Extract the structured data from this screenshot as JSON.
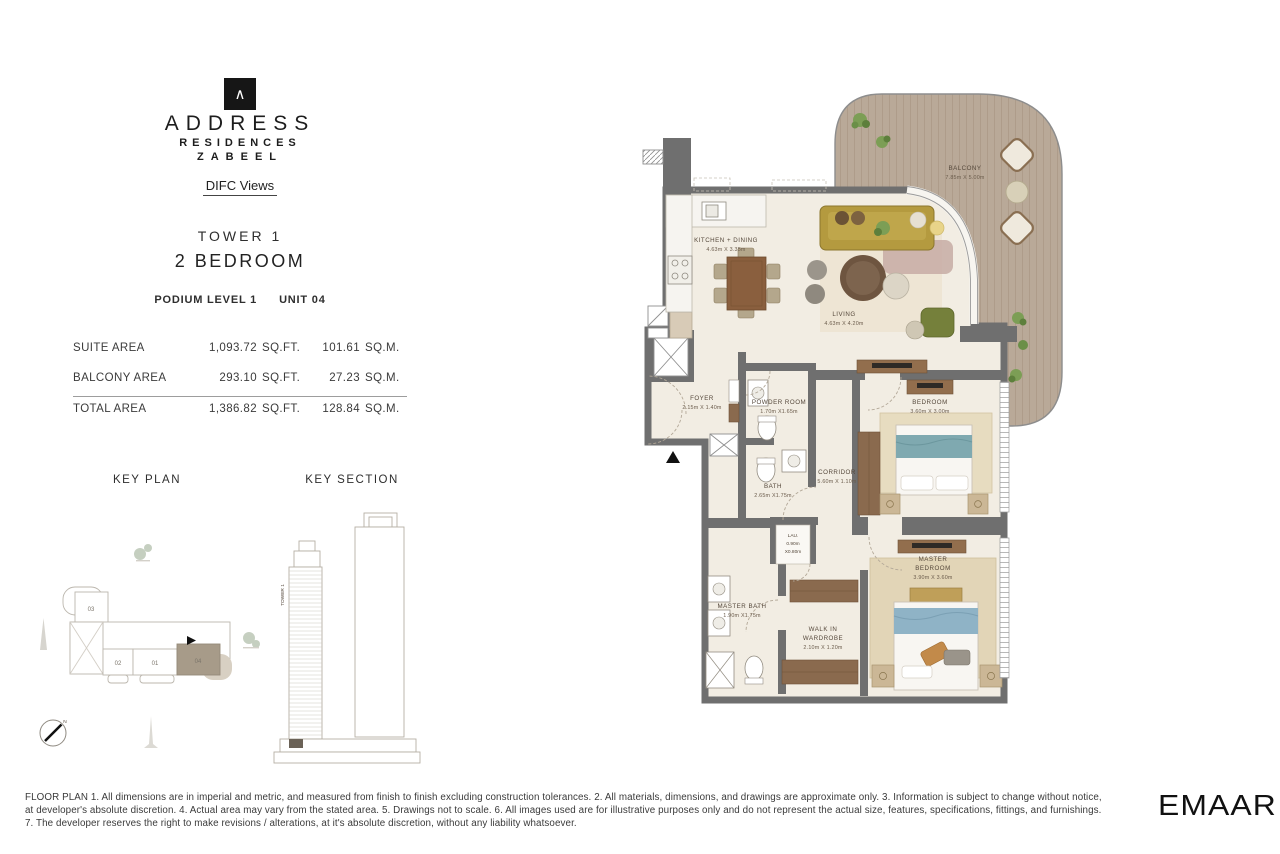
{
  "header": {
    "brand_mark": "∧",
    "brand_line1": "ADDRESS",
    "brand_line2": "RESIDENCES",
    "brand_line3": "ZABEEL",
    "subbrand": "DIFC Views",
    "tower": "TOWER 1",
    "unit_type": "2 BEDROOM",
    "level": "PODIUM LEVEL 1",
    "unit": "UNIT 04"
  },
  "area_table": {
    "rows": [
      {
        "label": "SUITE AREA",
        "sqft": "1,093.72",
        "sqft_unit": "SQ.FT.",
        "sqm": "101.61",
        "sqm_unit": "SQ.M."
      },
      {
        "label": "BALCONY AREA",
        "sqft": "293.10",
        "sqft_unit": "SQ.FT.",
        "sqm": "27.23",
        "sqm_unit": "SQ.M."
      },
      {
        "label": "TOTAL AREA",
        "sqft": "1,386.82",
        "sqft_unit": "SQ.FT.",
        "sqm": "128.84",
        "sqm_unit": "SQ.M."
      }
    ]
  },
  "key_plan": {
    "title": "KEY PLAN",
    "unit_03": "03",
    "unit_02": "02",
    "unit_01": "01",
    "unit_04": "04",
    "highlighted_unit": "04",
    "compass_n": "N"
  },
  "key_section": {
    "title": "KEY SECTION",
    "tower_label": "TOWER 1"
  },
  "floor_plan": {
    "rooms": {
      "kitchen": {
        "name": "KITCHEN + DINING",
        "dims": "4.63m X 3.35m"
      },
      "living": {
        "name": "LIVING",
        "dims": "4.63m X 4.20m"
      },
      "balcony": {
        "name": "BALCONY",
        "dims": "7.85m X 5.00m"
      },
      "foyer": {
        "name": "FOYER",
        "dims": "2.15m X 1.40m"
      },
      "powder": {
        "name": "POWDER ROOM",
        "dims": "1.70m X1.65m"
      },
      "bath": {
        "name": "BATH",
        "dims": "2.65m X1.75m"
      },
      "corridor": {
        "name": "CORRIDOR",
        "dims": "5.60m X 1.10m"
      },
      "bedroom": {
        "name": "BEDROOM",
        "dims": "3.60m X 3.00m"
      },
      "master_bedroom": {
        "name": "MASTER",
        "name2": "BEDROOM",
        "dims": "3.90m X 3.60m"
      },
      "laundry": {
        "name": "LAU.",
        "dims": "0.90m",
        "dims2": "X0.80m"
      },
      "master_bath": {
        "name": "MASTER BATH",
        "dims": "1.90m X1.75m"
      },
      "wardrobe": {
        "name": "WALK IN",
        "name2": "WARDROBE",
        "dims": "2.10m X 1.20m"
      }
    }
  },
  "colors": {
    "wall": "#6f6f6f",
    "floor": "#f2ede3",
    "deck": "#b9a998",
    "highlight_unit": "#a79b89",
    "sofa": "#b49a3f",
    "bed_throw": "#7fa9b0"
  },
  "footer": {
    "line1": "FLOOR PLAN 1. All dimensions are in imperial and metric, and measured from finish to finish excluding construction tolerances. 2. All materials, dimensions, and drawings are approximate only. 3. Information is subject to change without  notice,",
    "line2": "at developer's absolute discretion. 4. Actual area may vary from the stated area. 5. Drawings not to scale. 6. All images used are for illustrative purposes only and do not represent the actual size, features, specifications, fittings, and furnishings.",
    "line3": "7. The developer reserves the right to make revisions / alterations, at it's absolute discretion, without any liability whatsoever.",
    "logo": "EMAAR"
  }
}
